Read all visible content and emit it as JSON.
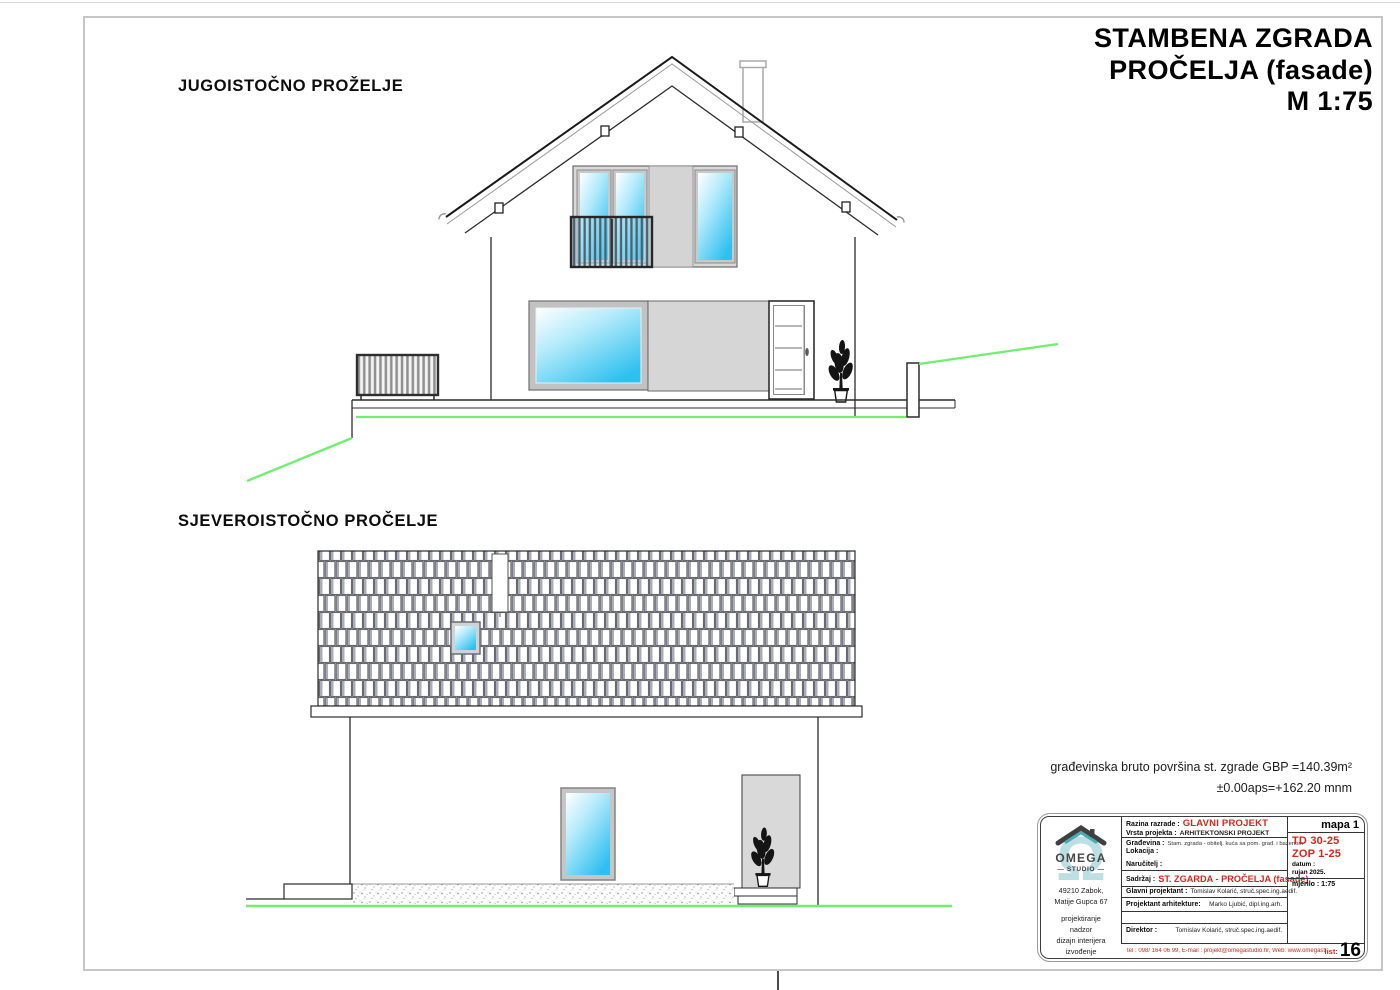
{
  "sheet": {
    "title_line1": "STAMBENA ZGRADA",
    "title_line2": "PROČELJA (fasade)",
    "title_line3": "M 1:75",
    "label_southeast": "JUGOISTOČNO PROŽELJE",
    "label_northeast": "SJEVEROISTOČNO PROČELJE",
    "gross_area_note": "građevinska bruto površina st. zgrade GBP =140.39m²",
    "elevation_datum_note": "±0.00aps=+162.20 mnm"
  },
  "colors": {
    "accent_red": "#d7261b",
    "glass_blue": "#2ec0ef",
    "ground_green": "#6fee6f",
    "logo_teal": "#bcdfe4"
  },
  "title_block": {
    "logo_text": "OMEGA",
    "logo_subtext": "— STUDIO —",
    "address_line1": "49210 Zabok,",
    "address_line2": "Matije Gupca 67",
    "services_line1": "projektiranje",
    "services_line2": "nadzor",
    "services_line3": "dizajn interijera",
    "services_line4": "izvođenje",
    "razina_label": "Razina razrade :",
    "razina_value": "GLAVNI PROJEKT",
    "vrsta_label": "Vrsta projekta :",
    "vrsta_value": "ARHITEKTONSKI PROJEKT",
    "gradevina_label": "Građevina :",
    "gradevina_value": "Stam. zgrada - obitelj. kuća sa pom. građ. i bazenom",
    "lokacija_label": "Lokacija :",
    "narucitelj_label": "Naručitelj :",
    "sadrzaj_label": "Sadržaj :",
    "sadrzaj_value": "ST. ZGARDA - PROČELJA (fasade)",
    "glavni_projektant_label": "Glavni projektant :",
    "glavni_projektant_value": "Tomislav Kolarić, struč.spec.ing.aedif.",
    "projektant_arhitekture_label": "Projektant arhitekture:",
    "projektant_arhitekture_value": "Marko Ljubić, dipl.ing.arh.",
    "direktor_label": "Direktor :",
    "direktor_value": "Tomislav Kolarić, struč.spec.ing.aedif.",
    "mapa": "mapa 1",
    "td_number": "TD 30-25",
    "zop_number": "ZOP 1-25",
    "datum_label": "datum :",
    "datum_value": "rujan 2025.",
    "mjerilo": "mjerilo : 1:75",
    "contact": "tel : 098/ 164 06 99, E-mail : projekt@omegastudio.hr, Web: www.omegastudio.hr",
    "list_label": "list:",
    "list_value": "16"
  }
}
